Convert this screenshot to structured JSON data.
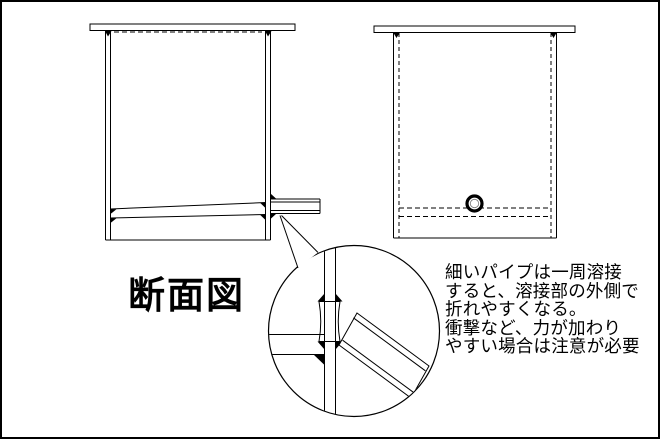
{
  "page": {
    "background_color": "#ffffff",
    "border_color": "#000000",
    "line_color": "#000000"
  },
  "title": {
    "label": "断面図"
  },
  "annotation": {
    "lines": [
      "細いパイプは一周溶接",
      "すると、溶接部の外側で",
      "折れやすくなる。",
      "衝撃など、力が加わり",
      "やすい場合は注意が必要"
    ]
  }
}
